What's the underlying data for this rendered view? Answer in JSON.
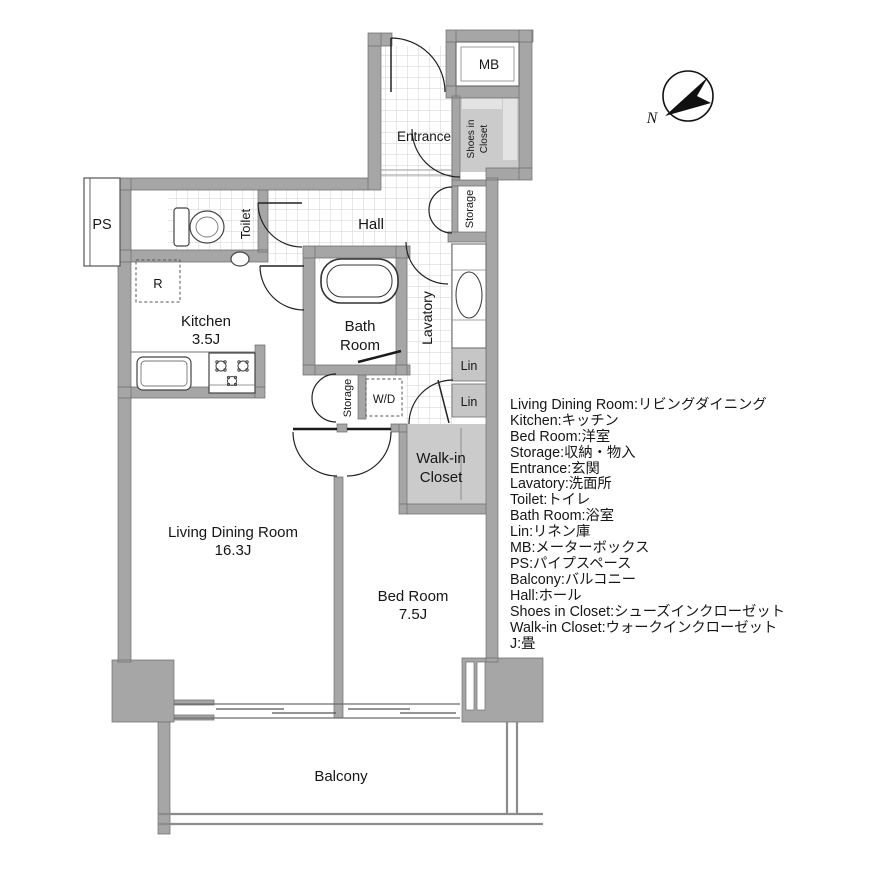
{
  "labels": {
    "living_name": "Living Dining Room",
    "living_size": "16.3J",
    "bed_name": "Bed Room",
    "bed_size": "7.5J",
    "kitchen_name": "Kitchen",
    "kitchen_size": "3.5J",
    "bath_line1": "Bath",
    "bath_line2": "Room",
    "hall": "Hall",
    "entrance": "Entrance",
    "toilet": "Toilet",
    "lavatory": "Lavatory",
    "storage_hall": "Storage",
    "storage_mid": "Storage",
    "shoes_line1": "Shoes in",
    "shoes_line2": "Closet",
    "walkin_line1": "Walk-in",
    "walkin_line2": "Closet",
    "lin_upper": "Lin",
    "lin_lower": "Lin",
    "mb": "MB",
    "ps": "PS",
    "wd": "W/D",
    "fridge": "R",
    "balcony": "Balcony"
  },
  "compass": {
    "north": "N"
  },
  "legend": {
    "lines": [
      "Living Dining Room:リビングダイニング",
      "Kitchen:キッチン",
      "Bed Room:洋室",
      "Storage:収納・物入",
      "Entrance:玄関",
      "Lavatory:洗面所",
      "Toilet:トイレ",
      "Bath Room:浴室",
      "Lin:リネン庫",
      "MB:メーターボックス",
      "PS:パイプスペース",
      "Balcony:バルコニー",
      "Hall:ホール",
      "Shoes in Closet:シューズインクローゼット",
      "Walk-in Closet:ウォークインクローゼット",
      "J:畳"
    ]
  },
  "colors": {
    "wall": "#a6a6a6",
    "closet": "#cbcbcb",
    "closet_light": "#e3e3e3",
    "lin": "#c6c6c6",
    "tile_line": "#d2d2d2"
  }
}
